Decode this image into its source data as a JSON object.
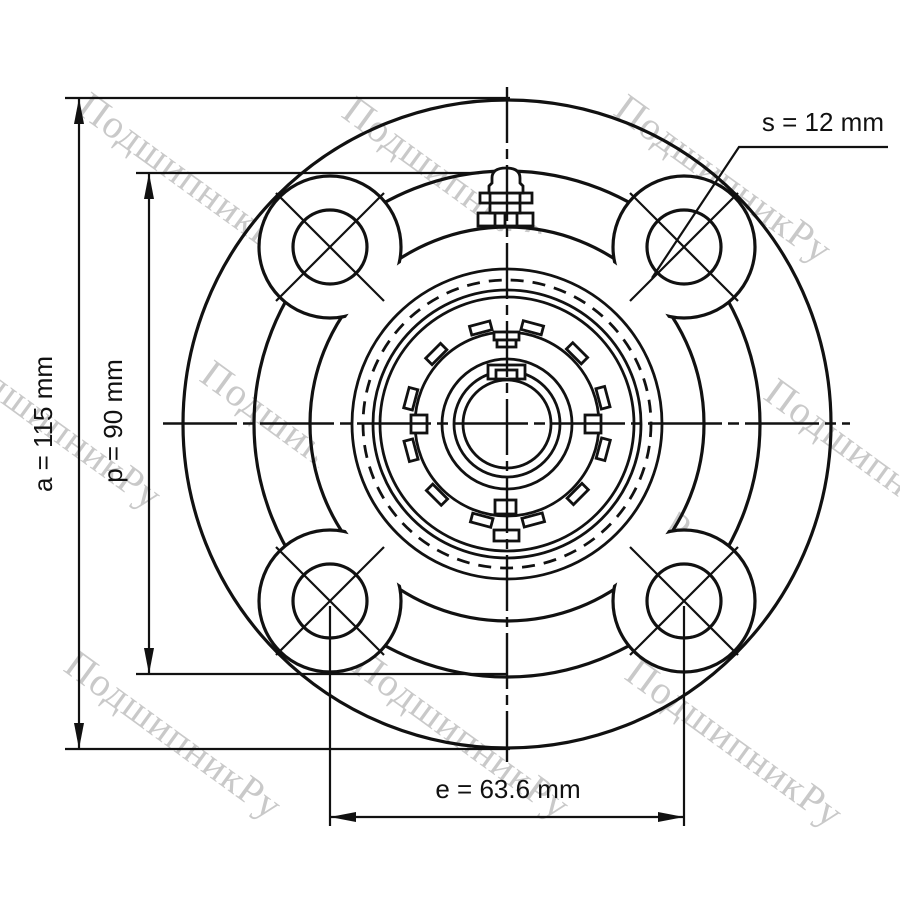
{
  "watermark": {
    "text": "ПодшипникРу",
    "color": "#c9c9c9"
  },
  "dimensions": {
    "a": "a = 115 mm",
    "p": "p = 90 mm",
    "s": "s = 12 mm",
    "e": "e = 63.6 mm"
  }
}
